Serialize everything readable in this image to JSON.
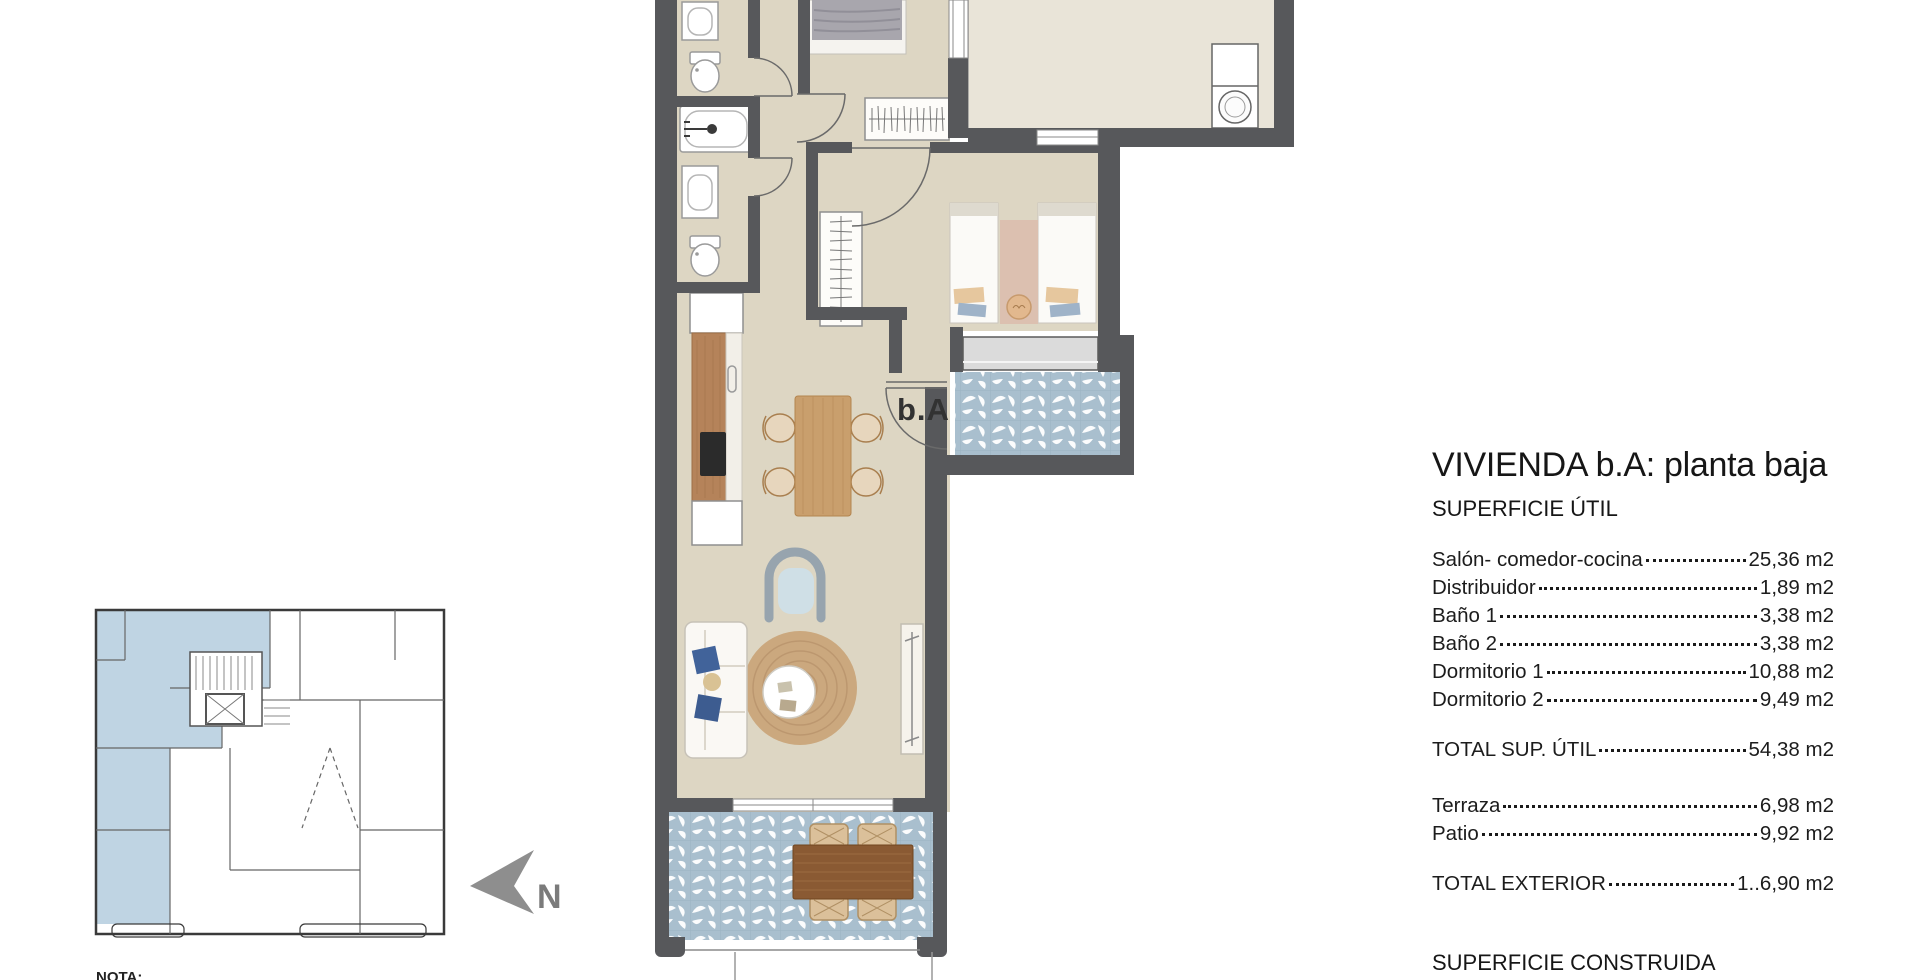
{
  "floor_plan": {
    "unit_label": "b.A"
  },
  "key_plan": {
    "north_label": "N",
    "note_label": "NOTA:"
  },
  "surface_table": {
    "title": "VIVIENDA b.A: planta baja",
    "section1_heading": "SUPERFICIE ÚTIL",
    "rows": [
      {
        "label": "Salón- comedor-cocina",
        "value": "25,36 m2"
      },
      {
        "label": "Distribuidor",
        "value": "1,89 m2"
      },
      {
        "label": "Baño 1",
        "value": "3,38 m2"
      },
      {
        "label": "Baño 2",
        "value": "3,38 m2"
      },
      {
        "label": "Dormitorio 1",
        "value": "10,88 m2"
      },
      {
        "label": "Dormitorio 2",
        "value": "9,49 m2"
      }
    ],
    "total_util": {
      "label": "TOTAL SUP. ÚTIL",
      "value": "54,38 m2"
    },
    "exterior_rows": [
      {
        "label": "Terraza",
        "value": "6,98 m2"
      },
      {
        "label": "Patio",
        "value": "9,92 m2"
      }
    ],
    "total_exterior": {
      "label": "TOTAL EXTERIOR",
      "value": "1..6,90 m2"
    },
    "section2_heading": "SUPERFICIE CONSTRUIDA"
  },
  "colors": {
    "wall": "#57585b",
    "interior_floor": "#ddd6c3",
    "patio_floor": "#e9e4d8",
    "tile_blue": "#a9bfce",
    "keyplan_highlight": "#bfd4e3",
    "north_arrow": "#8e8e8e"
  }
}
